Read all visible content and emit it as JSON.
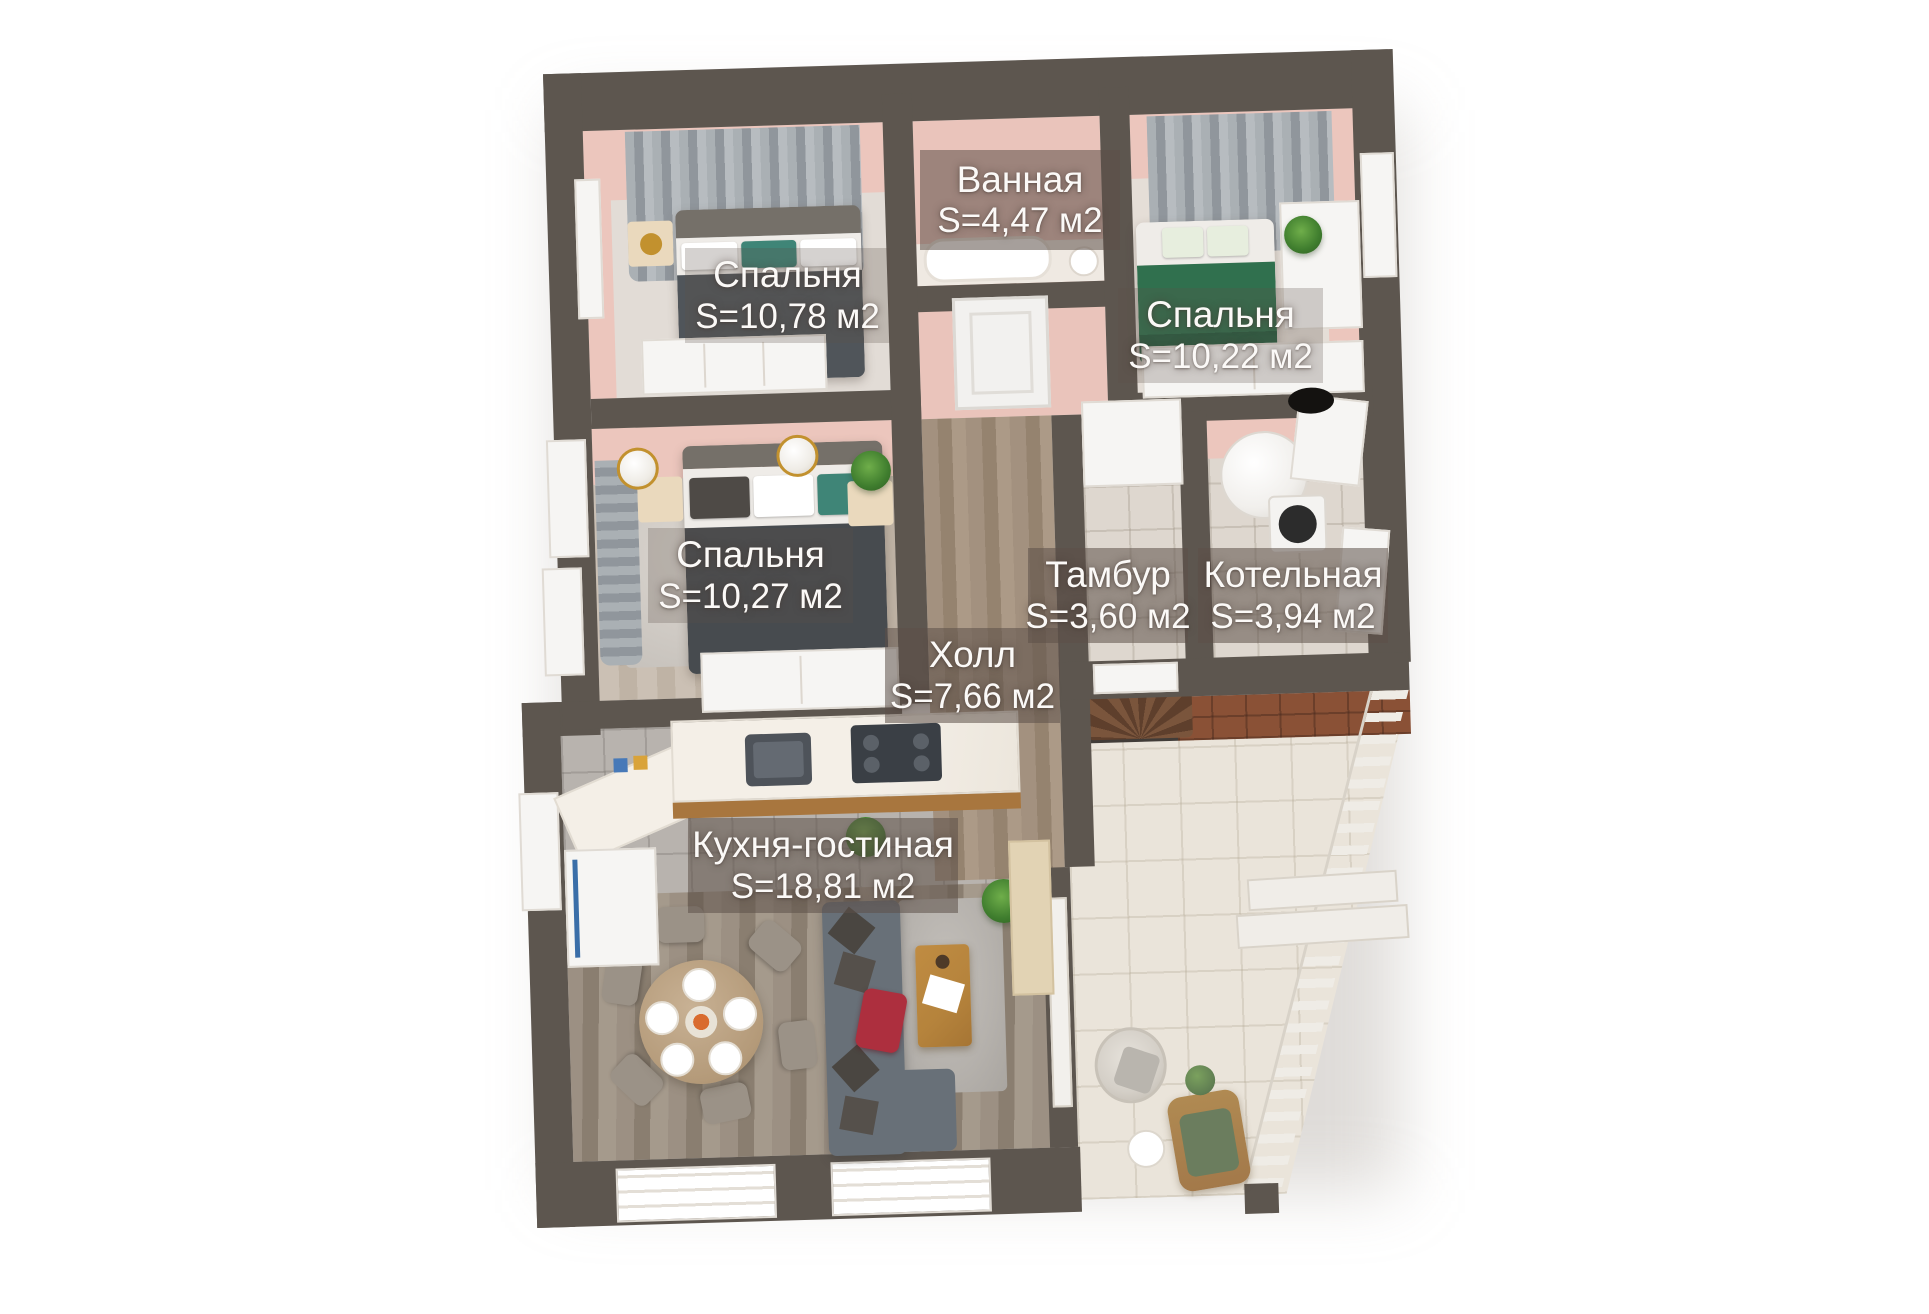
{
  "plan": {
    "palette": {
      "wall": "#5d564f",
      "inner_wall_pink": "#ecc6bd",
      "label_box": "rgba(92,80,73,0.55)",
      "label_text": "#fbf9f7",
      "terrace_tile": "#eae4da",
      "brick_path": "#8a5136",
      "sofa": "#687078",
      "bed_blanket": "#50555a",
      "green_bed": "#30704e",
      "accent_red": "#ad2f3e"
    },
    "rooms": [
      {
        "id": "bathroom",
        "name": "Ванная",
        "area": "S=4,47 м2"
      },
      {
        "id": "bedroom-top-left",
        "name": "Спальня",
        "area": "S=10,78 м2"
      },
      {
        "id": "bedroom-top-right",
        "name": "Спальня",
        "area": "S=10,22 м2"
      },
      {
        "id": "bedroom-mid-left",
        "name": "Спальня",
        "area": "S=10,27 м2"
      },
      {
        "id": "vestibule",
        "name": "Тамбур",
        "area": "S=3,60 м2"
      },
      {
        "id": "boiler-room",
        "name": "Котельная",
        "area": "S=3,94 м2"
      },
      {
        "id": "hall",
        "name": "Холл",
        "area": "S=7,66 м2"
      },
      {
        "id": "kitchen-living",
        "name": "Кухня-гостиная",
        "area": "S=18,81 м2"
      }
    ]
  }
}
